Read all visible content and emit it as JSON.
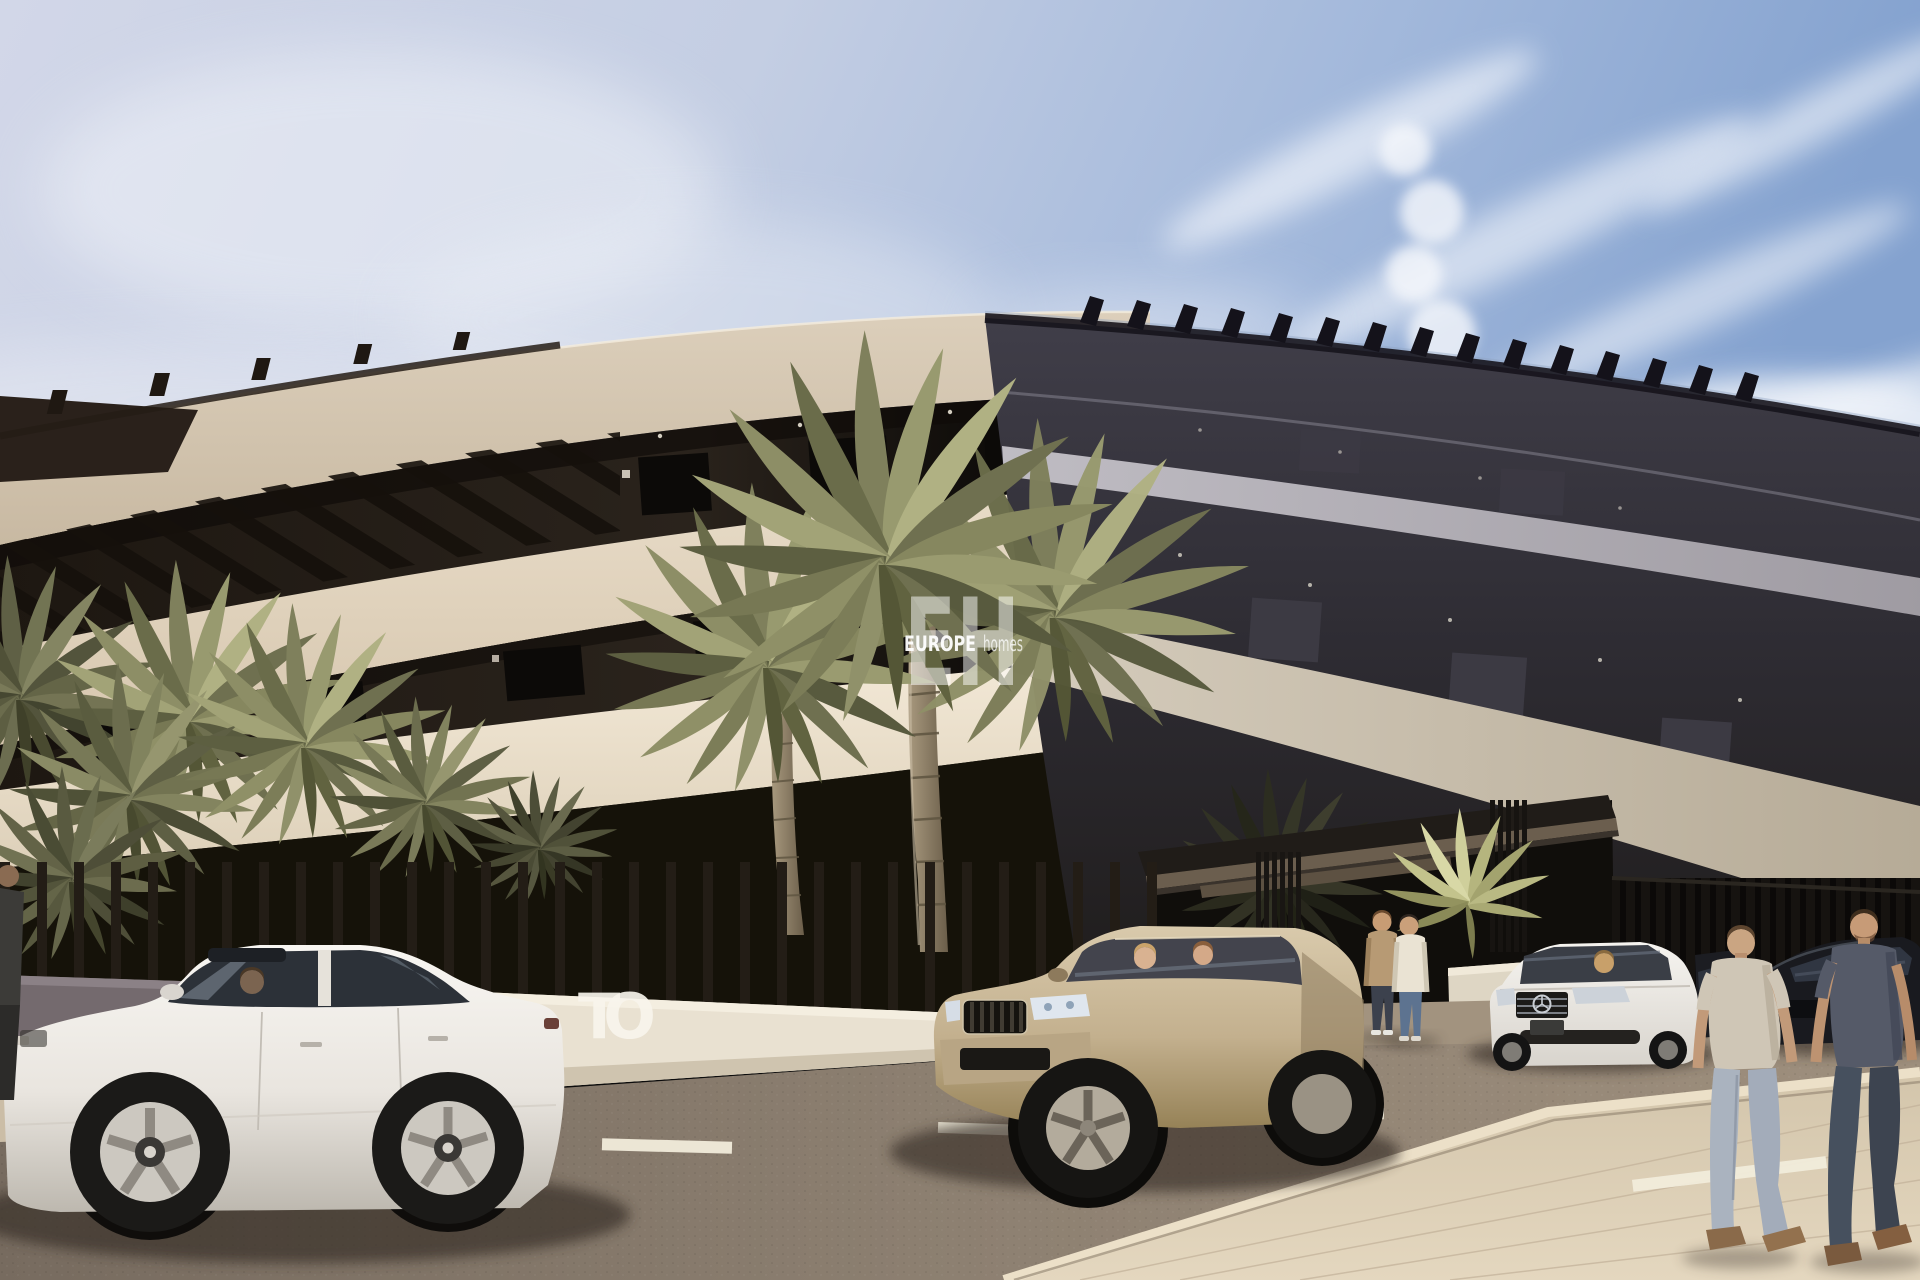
{
  "image": {
    "kind": "3d-architectural-render",
    "subject": "Curved modern apartment building with street, palm trees, cars and pedestrians",
    "time_of_day": "day"
  },
  "watermark": {
    "initials": "EH",
    "brand_primary": "EUROPE",
    "brand_secondary": "homes",
    "color": "#ffffff"
  },
  "wall_sign": {
    "visible_letters": "TO",
    "color": "#f7f4ec"
  },
  "palette": {
    "sky_left": "#ccd4e7",
    "sky_right": "#86a4d0",
    "cloud": "#f4f7fc",
    "facade_cream_top": "#d8cab4",
    "facade_cream_mid": "#e7dbc7",
    "facade_cream_low": "#f2e8d6",
    "facade_recess_dark": "#241d17",
    "facade_shadow_side": "#34323b",
    "shadow_band_light": "#b9b6bd",
    "entrance_canopy": "#201c18",
    "fence_slats": "#231d16",
    "wall_left": "#746a6e",
    "wall_white": "#e9e1d1",
    "palm_olive": "#757553",
    "palm_light": "#b7b78c",
    "road": "#8b7e70",
    "sidewalk": "#d9ccb4",
    "road_marking": "#f2ecdc",
    "car_white_sedan": "#f2f0ea",
    "car_suv_champagne": "#c8b695",
    "car_mercedes_white": "#f3f1ed",
    "car_dark": "#1a1b20"
  },
  "scene_objects": {
    "vehicles": [
      "white-sedan-driving-left",
      "champagne-suv",
      "white-mercedes-parked",
      "black-sedan-parked",
      "dark-car-sliver"
    ],
    "people": [
      "pedestrian-left-edge",
      "two-people-talking-at-entrance",
      "two-men-walking-on-sidewalk"
    ],
    "vegetation": [
      "center-palm-trees",
      "left-palm-shrubs",
      "entrance-palm-shrub"
    ]
  }
}
